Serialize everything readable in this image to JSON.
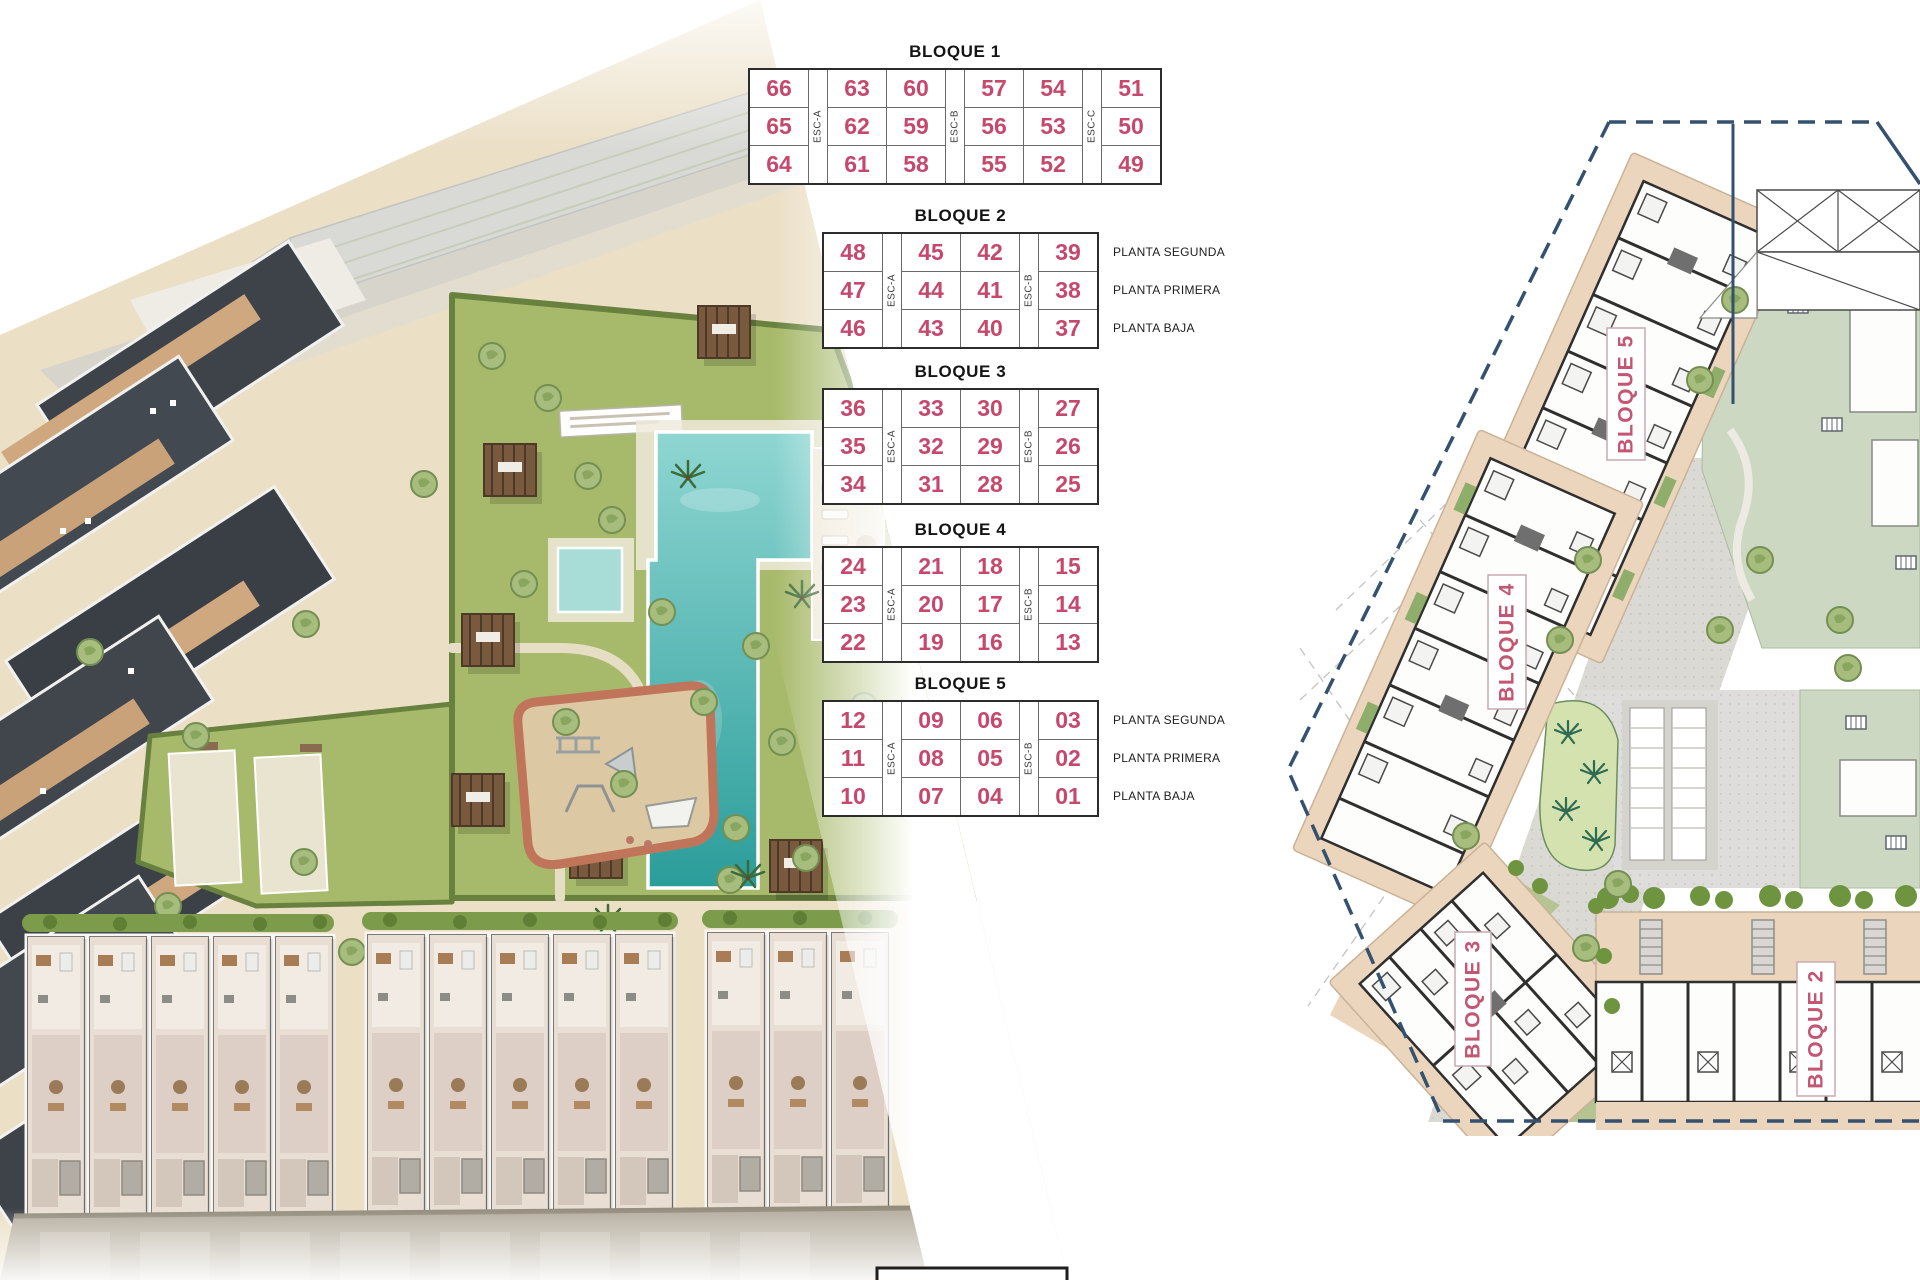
{
  "page": {
    "background": "#ffffff"
  },
  "colors": {
    "unit_number": "#c5496d",
    "table_line": "#2c2c2c",
    "plan_label_pink": "#c35672",
    "boundary_navy": "#34516f",
    "pool_teal": "#2b9d9a",
    "lawn_green": "#a7b96a",
    "building_beige": "#ecd5bd",
    "sand": "#ebdfc6"
  },
  "blocks": [
    {
      "title": "BLOQUE 1",
      "cols": [
        [
          "66",
          "65",
          "64"
        ],
        [
          "63",
          "62",
          "61"
        ],
        [
          "60",
          "59",
          "58"
        ],
        [
          "57",
          "56",
          "55"
        ],
        [
          "54",
          "53",
          "52"
        ],
        [
          "51",
          "50",
          "49"
        ]
      ],
      "escaleras": [
        "ESC-A",
        "ESC-B",
        "ESC-C"
      ],
      "plantas": []
    },
    {
      "title": "BLOQUE 2",
      "cols": [
        [
          "48",
          "47",
          "46"
        ],
        [
          "45",
          "44",
          "43"
        ],
        [
          "42",
          "41",
          "40"
        ],
        [
          "39",
          "38",
          "37"
        ]
      ],
      "escaleras": [
        "ESC-A",
        "ESC-B"
      ],
      "plantas": [
        "PLANTA SEGUNDA",
        "PLANTA PRIMERA",
        "PLANTA BAJA"
      ]
    },
    {
      "title": "BLOQUE 3",
      "cols": [
        [
          "36",
          "35",
          "34"
        ],
        [
          "33",
          "32",
          "31"
        ],
        [
          "30",
          "29",
          "28"
        ],
        [
          "27",
          "26",
          "25"
        ]
      ],
      "escaleras": [
        "ESC-A",
        "ESC-B"
      ],
      "plantas": []
    },
    {
      "title": "BLOQUE 4",
      "cols": [
        [
          "24",
          "23",
          "22"
        ],
        [
          "21",
          "20",
          "19"
        ],
        [
          "18",
          "17",
          "16"
        ],
        [
          "15",
          "14",
          "13"
        ]
      ],
      "escaleras": [
        "ESC-A",
        "ESC-B"
      ],
      "plantas": []
    },
    {
      "title": "BLOQUE 5",
      "cols": [
        [
          "12",
          "11",
          "10"
        ],
        [
          "09",
          "08",
          "07"
        ],
        [
          "06",
          "05",
          "04"
        ],
        [
          "03",
          "02",
          "01"
        ]
      ],
      "escaleras": [
        "ESC-A",
        "ESC-B"
      ],
      "plantas": [
        "PLANTA SEGUNDA",
        "PLANTA PRIMERA",
        "PLANTA BAJA"
      ]
    }
  ],
  "site_plan": {
    "label_color": "#c35672",
    "labels": [
      {
        "text": "BLOQUE 5"
      },
      {
        "text": "BLOQUE 4"
      },
      {
        "text": "BLOQUE 3"
      },
      {
        "text": "BLOQUE 2"
      }
    ]
  }
}
